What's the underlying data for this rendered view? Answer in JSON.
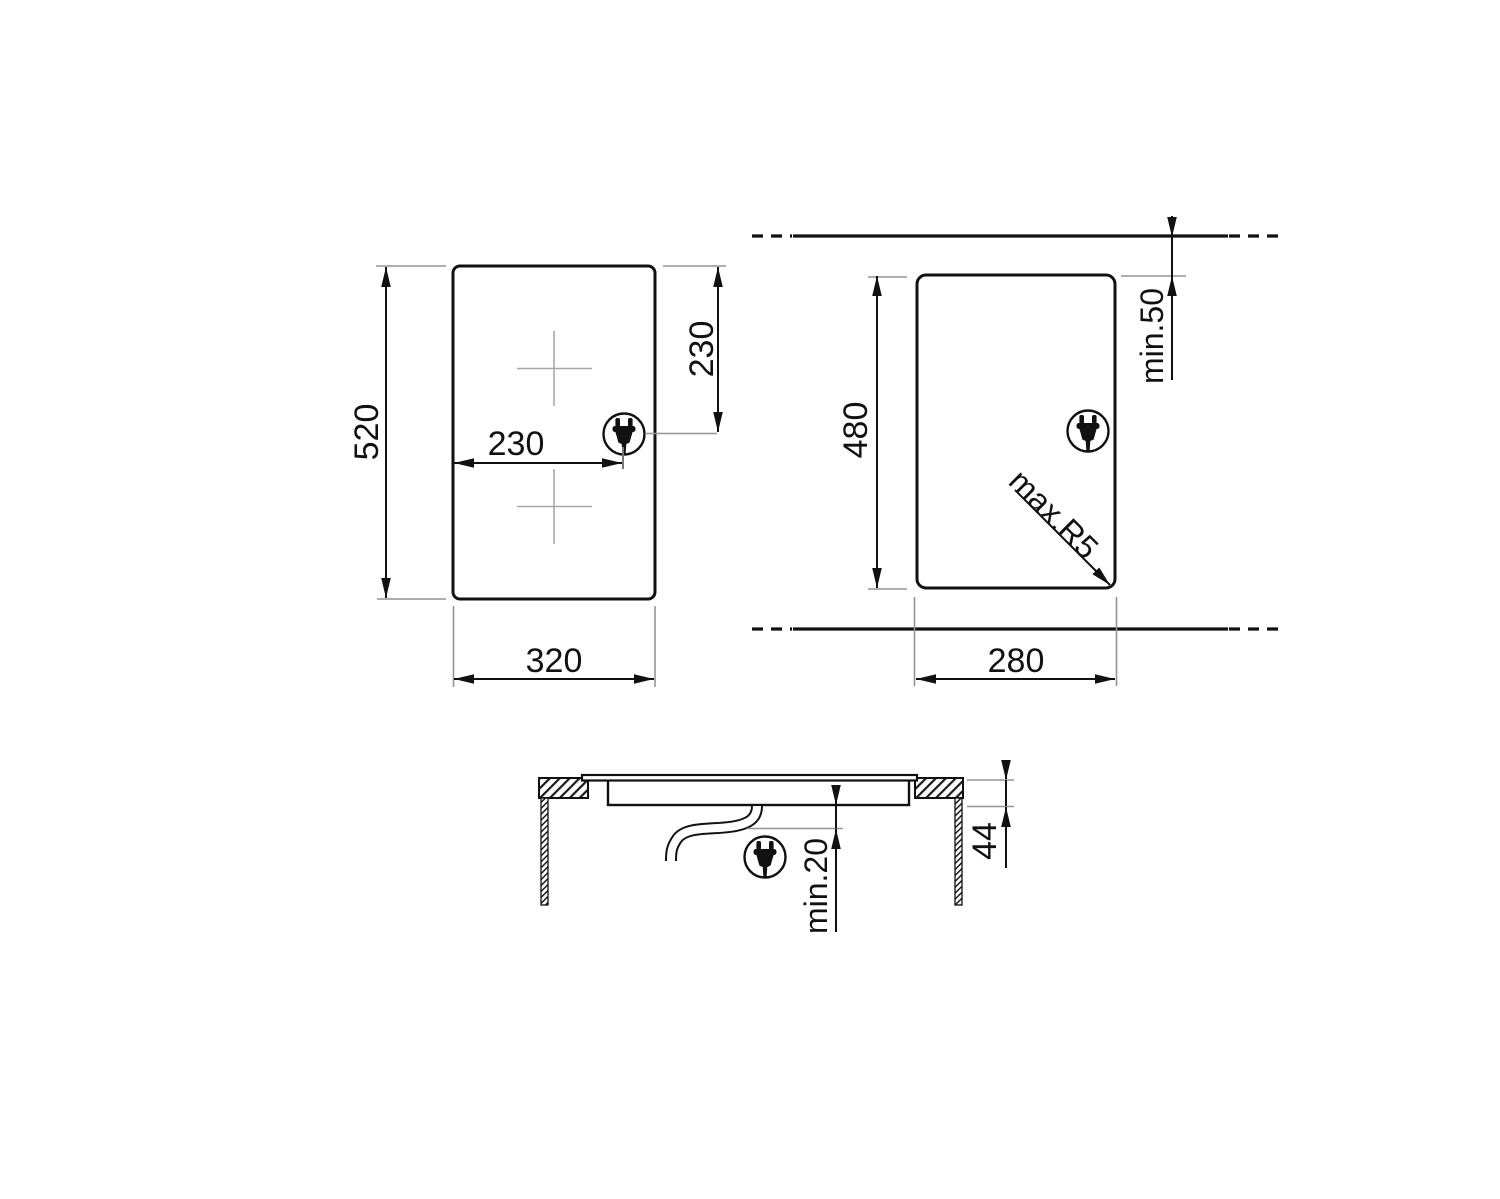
{
  "title": "hob-installation-dimension-drawing",
  "colors": {
    "line": "#111111",
    "thin_gray": "#949494",
    "cross_gray": "#a8a8a8",
    "background": "#ffffff"
  },
  "views": {
    "top_view": {
      "height": "520",
      "width": "320",
      "zone_offset_x": "230",
      "zone_offset_y": "230"
    },
    "cutout_view": {
      "height": "480",
      "width": "280",
      "rear_clearance": "min.50",
      "max_corner_radius": "max.R5"
    },
    "section_view": {
      "depth": "44",
      "min_clearance_below": "min.20"
    }
  }
}
